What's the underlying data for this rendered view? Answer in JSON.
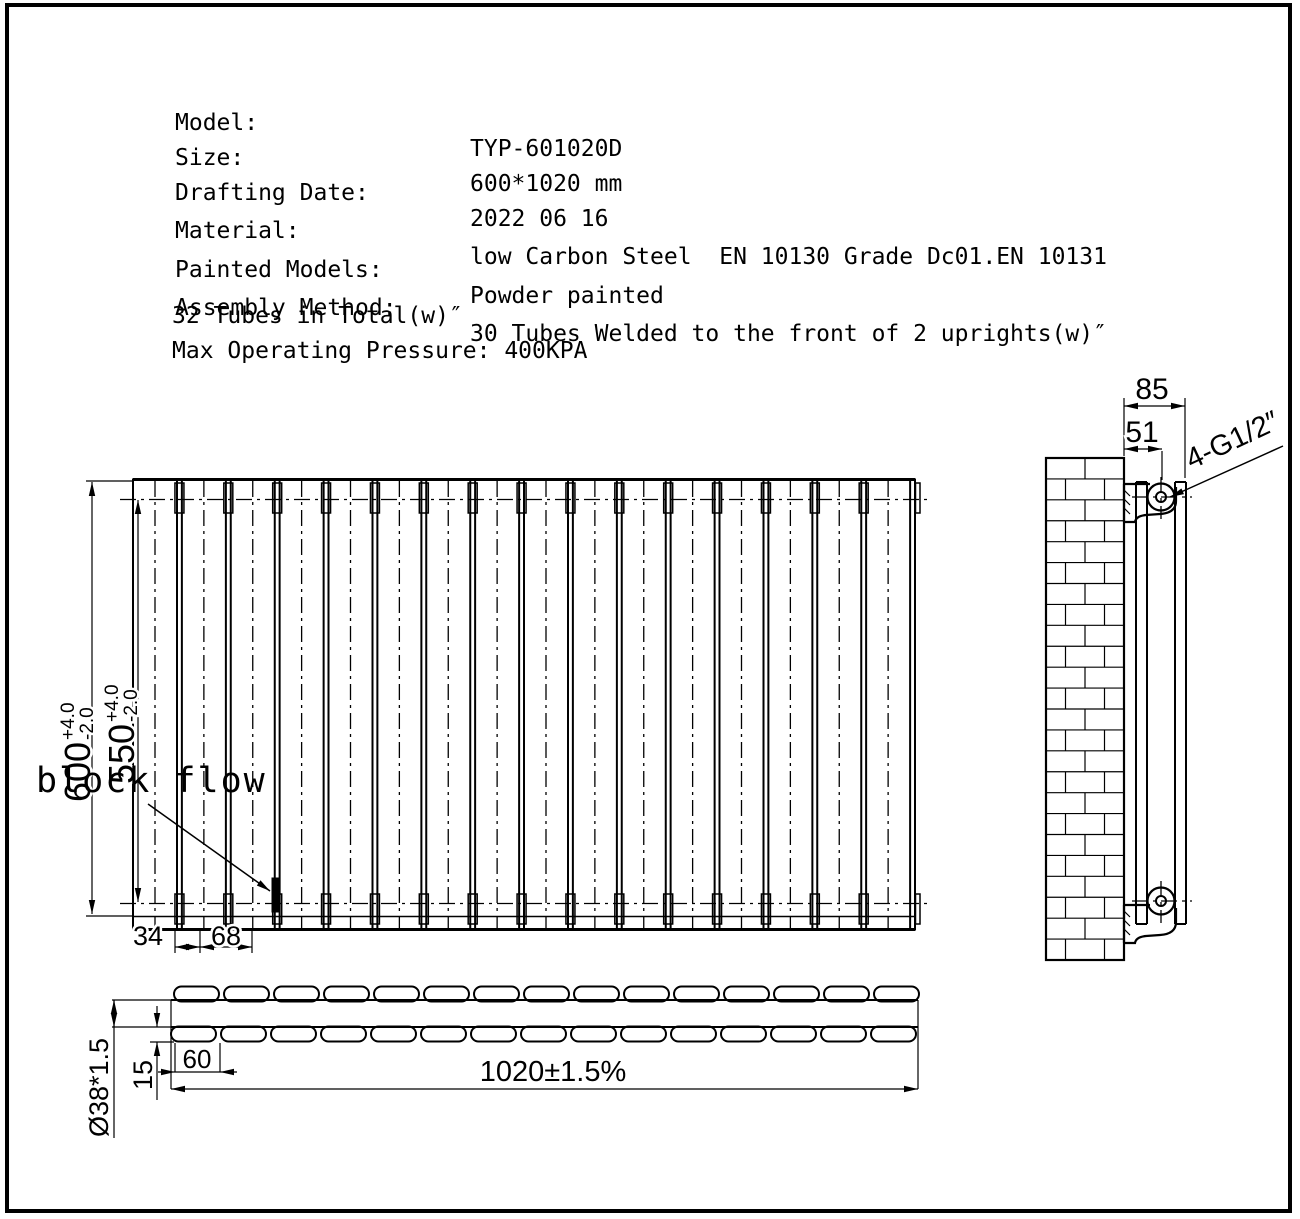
{
  "specs": {
    "rows": [
      {
        "label": "Model:",
        "value": "TYP-601020D"
      },
      {
        "label": "Size:",
        "value": "600*1020 mm"
      },
      {
        "label": "Drafting Date:",
        "value": "2022 06 16"
      },
      {
        "label": "Material:",
        "value": "low Carbon Steel  EN 10130 Grade Dc01.EN 10131"
      },
      {
        "label": "Painted Models:",
        "value": "Powder painted"
      },
      {
        "label": "Assembly Method:",
        "value": "30 Tubes Welded to the front of 2 uprights(w)″"
      }
    ],
    "line7": "32 Tubes in Total(w)″",
    "line8": "Max Operating Pressure: 400KPA"
  },
  "front_view": {
    "height": "600",
    "height_tol_plus": "+4.0",
    "height_tol_minus": "-2.0",
    "tube_height": "550",
    "tube_tol_plus": "+4.0",
    "tube_tol_minus": "-2.0",
    "dim_34": "34",
    "dim_68": "68",
    "block_flow_label": "block flow",
    "panel_count": 16
  },
  "side_view": {
    "depth": "85",
    "port_offset": "51",
    "thread": "4-G1/2″",
    "brick_rows": 24
  },
  "top_view": {
    "tube_spec": "Ø38*1.5",
    "gap": "15",
    "tube_width": "60",
    "overall_width": "1020±1.5%",
    "tubes_per_row": 15
  },
  "colors": {
    "line": "#000000",
    "background": "#ffffff"
  }
}
